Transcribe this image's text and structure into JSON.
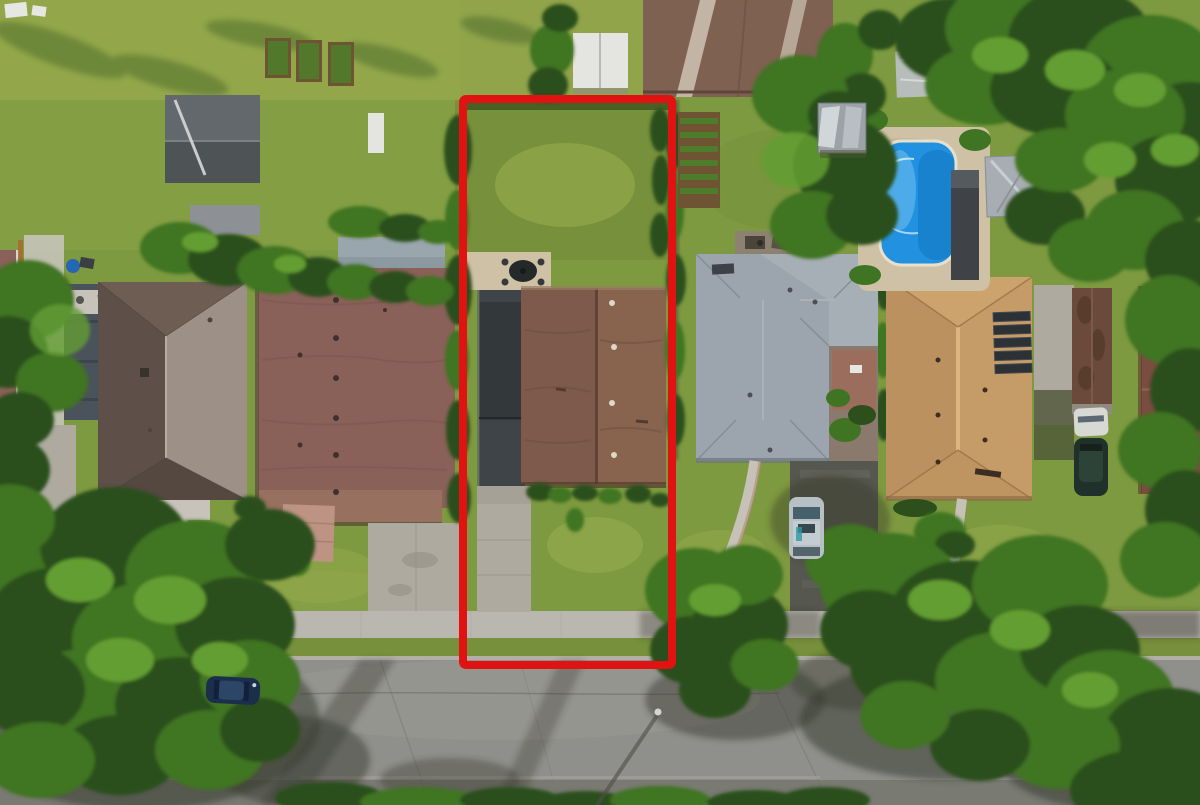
{
  "scene": {
    "kind": "aerial real-estate photograph",
    "description": "Top-down drone photo of a suburban block; one lot is outlined with a red property boundary. Houses with brown, gray and orange roofs, driveways, sidewalk and street at bottom, backyard swimming pool upper right, large tree canopies.",
    "objects": [
      "red-property-boundary",
      "subject-house-roof",
      "subject-garage",
      "subject-driveway",
      "subject-backyard",
      "patio-furniture",
      "left-hip-roof-house",
      "brown-shingle-house",
      "gray-l-shaped-house",
      "orange-tile-house",
      "solar-panels",
      "swimming-pool",
      "pool-deck",
      "metal-gazebo",
      "gray-shed",
      "white-shed",
      "barn-roof",
      "vegetable-garden",
      "raised-garden-beds",
      "street",
      "sidewalk",
      "tree-canopy",
      "parked-car-street",
      "parked-car-driveway",
      "white-car",
      "dark-suv",
      "brown-garage",
      "utility-pole"
    ]
  },
  "boundary": {
    "x": 463,
    "y": 99,
    "width": 209,
    "height": 566,
    "stroke_width": 8,
    "color": "#e01212"
  },
  "colors": {
    "grassBase": "#7e9a40",
    "grassLight": "#9ab04f",
    "grassOlive": "#77903b",
    "grassDark": "#67853374",
    "grassYellow": "#a8b156",
    "treeDark": "#2c4f1c",
    "treeMid": "#3f7423",
    "treeLight": "#639e33",
    "shadow": "#34372b",
    "road": "#8f8f8b",
    "roadDark": "#6f7068",
    "sidewalk": "#bab7b0",
    "curb": "#b2afa7",
    "concrete": "#aeaaa0",
    "concreteLight": "#c7c3ba",
    "asphalt": "#56574f",
    "garageDark": "#33383b",
    "garageDark2": "#3f4449",
    "roofTaupeTop": "#6e5d53",
    "roofTaupeDark": "#5e5048",
    "roofTaupeLight": "#9c9087",
    "roofTaupeBottom": "#544840",
    "roofBrownRed": "#8a6159",
    "roofBrownRedLight": "#97705f",
    "roofCenterBrown": "#7d5a4b",
    "roofCenterBrownLight": "#88644f",
    "roofGray": "#9ca5ad",
    "roofGrayLight": "#a9b1b8",
    "roofOrange": "#c59c67",
    "roofOrangeLight": "#d2aa73",
    "roofOrangeDark": "#a87f52",
    "roofRightBrown": "#7b4c41",
    "roofBarn": "#7f6152",
    "barnStreak": "#cabfae",
    "garageBrown": "#6b4a3b",
    "poolBlue": "#2292e0",
    "poolBlueDark": "#1478c2",
    "poolDeck": "#cfc1a5",
    "shedWhite": "#e4e4e0",
    "shedGray": "#a7adb2",
    "gazeboMetal": "#9ba3a9",
    "soil": "#6f5434",
    "gardenGreen": "#4e7c2a",
    "brick": "#bd9384",
    "white": "#e6e6e3",
    "darkItem": "#3c3f42",
    "carNavy": "#1b2f4c",
    "carSilver": "#b7c0c5",
    "carWhite": "#d8d9d5",
    "suvDark": "#20302a"
  }
}
